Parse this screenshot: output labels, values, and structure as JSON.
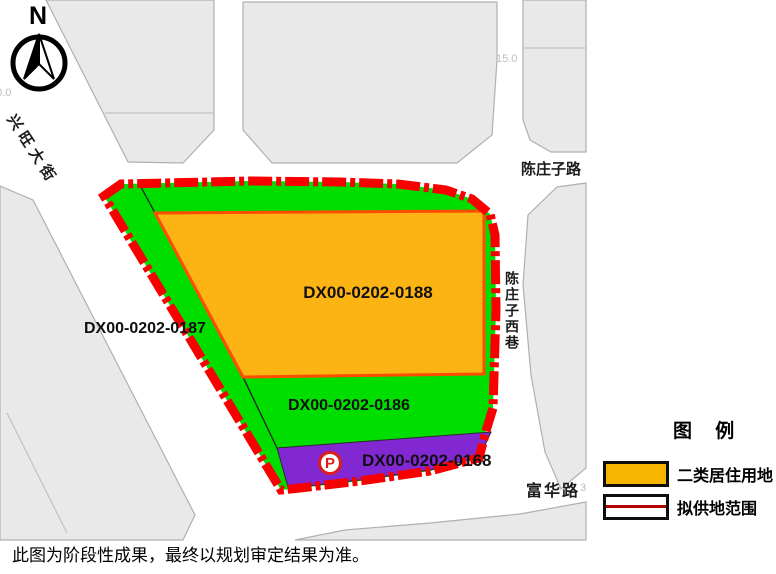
{
  "map": {
    "compass_label": "N",
    "street_labels": {
      "xingwang_street": "兴旺大街",
      "chenzhuangzi_road": "陈庄子路",
      "chenzhuangzi_west_lane": "陈庄子西巷",
      "fuhua_road": "富华路"
    },
    "dimension_annotations": {
      "left_clipped": "30.0",
      "top": "15.0",
      "bottom_clipped": "3"
    },
    "parcels": [
      {
        "id": "DX00-0202-0188"
      },
      {
        "id": "DX00-0202-0187"
      },
      {
        "id": "DX00-0202-0186"
      },
      {
        "id": "DX00-0202-0168"
      }
    ],
    "parking_label": "P"
  },
  "legend": {
    "title": "图 例",
    "items": [
      {
        "label": "二类居住用地",
        "swatch": "orange-fill"
      },
      {
        "label": "拟供地范围",
        "swatch": "red-boundary-line"
      }
    ]
  },
  "disclaimer": "此图为阶段性成果，最终以规划审定结果为准。",
  "colors": {
    "site_green": "#00de00",
    "residential_orange": "#fcb414",
    "orange_parcel_border": "#ff4d00",
    "parcel_purple": "#8228d2",
    "boundary_red": "#f80000",
    "legend_orange": "#f5b500",
    "legend_red_line": "#b30000",
    "block_gray": "#e9e9e9",
    "block_stroke": "#b0b0b0"
  }
}
